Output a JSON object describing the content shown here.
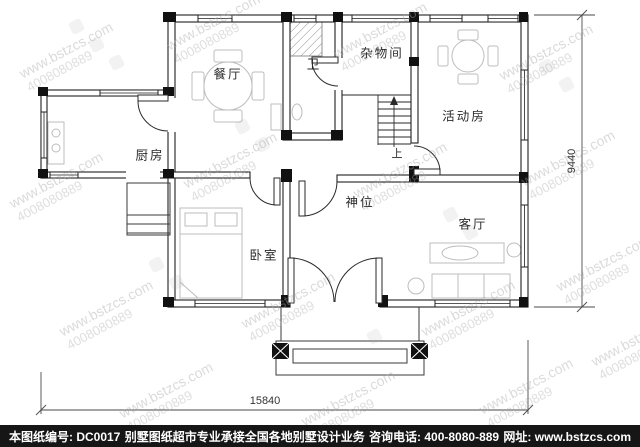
{
  "plan": {
    "rooms": {
      "dining": "餐厅",
      "bath": "卫",
      "storage": "杂物间",
      "activity": "活动房",
      "kitchen": "厨房",
      "shrine": "神位",
      "bedroom": "卧室",
      "living": "客厅",
      "stair_up": "上"
    },
    "dimensions": {
      "width": "15840",
      "height": "9440"
    }
  },
  "watermark": {
    "site": "www.bstzcs.com",
    "phone": "4008080889"
  },
  "footer": {
    "drawing_no": "本图纸编号: DC0017",
    "service": "别墅图纸超市专业承接全国各地别墅设计业务",
    "phone": "咨询电话: 400-8080-889",
    "website": "网址: www.bstzcs.com"
  }
}
